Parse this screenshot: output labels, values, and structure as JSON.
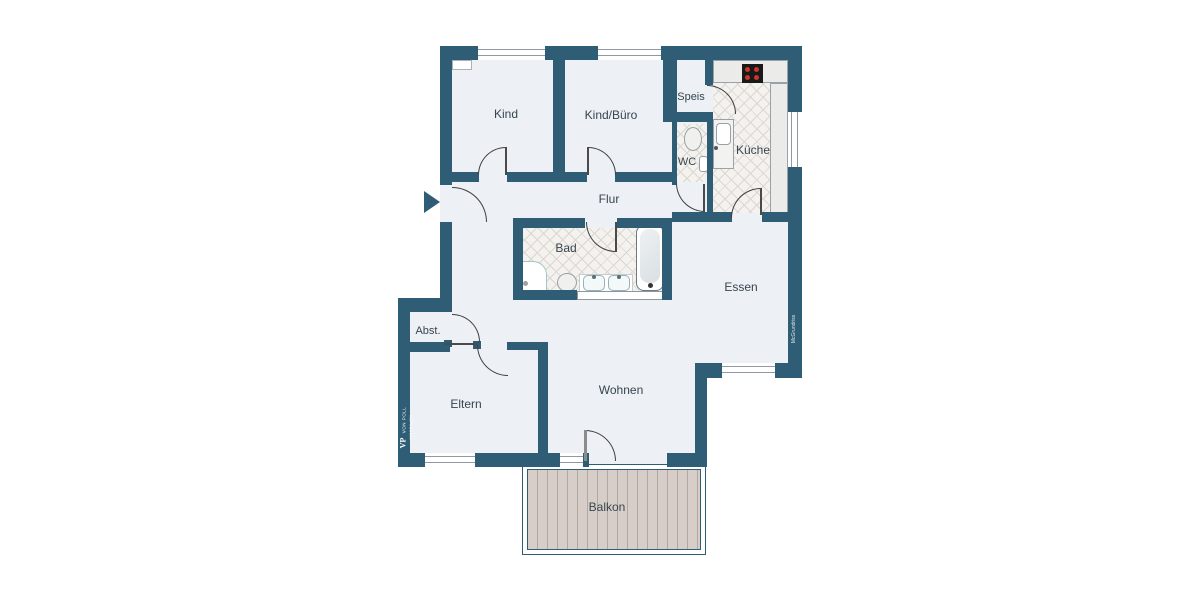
{
  "floorplan": {
    "title": "Wohnung Grundriss",
    "rooms": [
      {
        "id": "kind",
        "label": "Kind"
      },
      {
        "id": "kind_buero",
        "label": "Kind/Büro"
      },
      {
        "id": "speis",
        "label": "Speis"
      },
      {
        "id": "wc",
        "label": "WC"
      },
      {
        "id": "kueche",
        "label": "Küche"
      },
      {
        "id": "flur",
        "label": "Flur"
      },
      {
        "id": "bad",
        "label": "Bad"
      },
      {
        "id": "essen",
        "label": "Essen"
      },
      {
        "id": "abst",
        "label": "Abst."
      },
      {
        "id": "eltern",
        "label": "Eltern"
      },
      {
        "id": "wohnen",
        "label": "Wohnen"
      },
      {
        "id": "balkon",
        "label": "Balkon"
      }
    ],
    "logo": {
      "prefix": "VP",
      "name": "VON POLL",
      "sub": "IMMOBILIEN"
    },
    "watermark": "McGrundriss",
    "colors": {
      "wall": "#2e5d75",
      "floor": "#edf0f5",
      "tile_base": "#f4f2ef",
      "tile_line": "#dcd6cf",
      "plank": "#d8cec9",
      "label_text": "#36454f",
      "burner_red": "#c8362c",
      "stove_black": "#191919"
    }
  }
}
